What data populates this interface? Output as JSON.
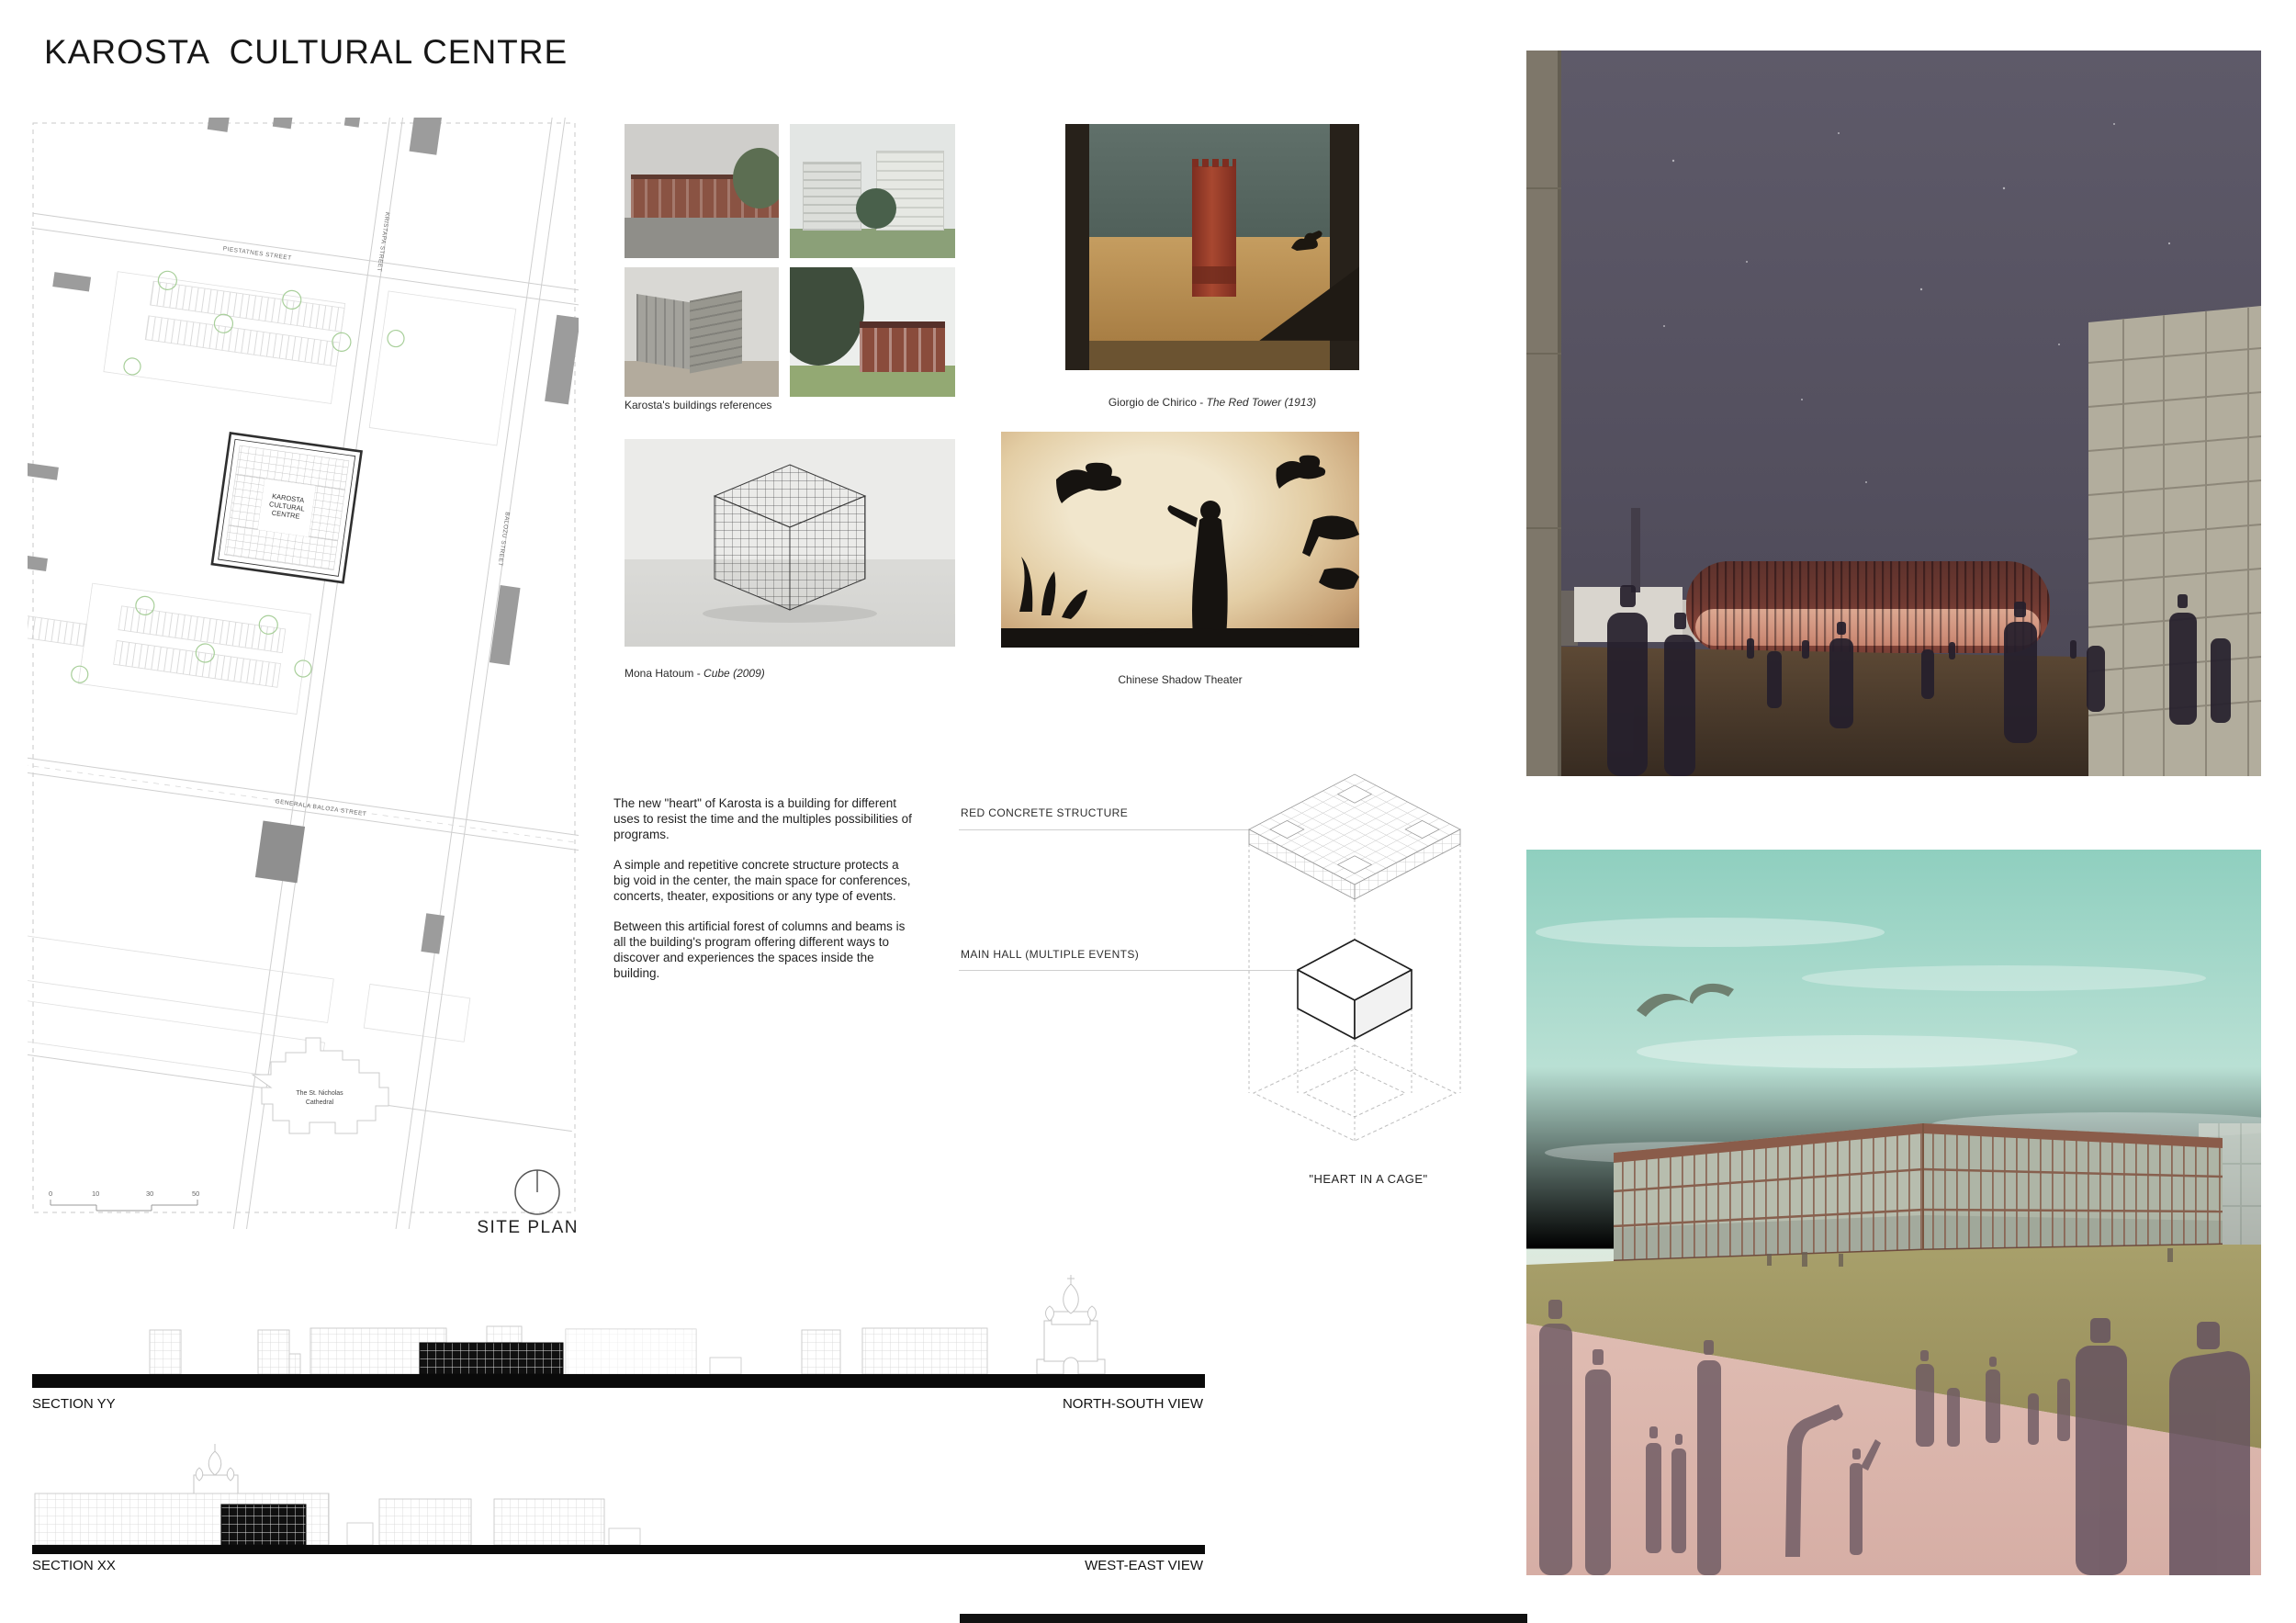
{
  "board": {
    "title": "KAROSTA  CULTURAL CENTRE"
  },
  "site_plan": {
    "label": "SITE PLAN",
    "centre_label": [
      "KAROSTA",
      "CULTURAL",
      "CENTRE"
    ],
    "cathedral_label": [
      "The St. Nicholas",
      "Cathedral"
    ],
    "street_labels": {
      "top_horizontal": "PIESTATNES STREET",
      "top_vertical": "KRISTAPA STREET",
      "mid_vertical": "BALOZU STREET",
      "main_horizontal": "GENERALA BALOZA STREET"
    },
    "scale_ticks": [
      "0",
      "10",
      "30",
      "50"
    ]
  },
  "references": {
    "caption": "Karosta's buildings references"
  },
  "artworks": {
    "chirico": {
      "artist": "Giorgio de Chirico - ",
      "work": "The Red Tower (1913)"
    },
    "hatoum": {
      "artist": "Mona Hatoum - ",
      "work": "Cube (2009)"
    },
    "shadow": {
      "caption": "Chinese Shadow Theater"
    }
  },
  "concept": {
    "p1": "The new \"heart\" of Karosta is a building for different uses to resist the time and the multiples possibilities of programs.",
    "p2": "A simple and repetitive concrete structure protects a big void in the center, the main space for conferences, concerts, theater, expositions or any type of events.",
    "p3": "Between this artificial forest of columns and beams is all the building's program offering different ways to discover and experiences the spaces inside the building."
  },
  "diagram": {
    "structure_label": "RED CONCRETE STRUCTURE",
    "hall_label": "MAIN HALL (MULTIPLE EVENTS)",
    "caption": "\"HEART IN A CAGE\""
  },
  "sections": {
    "yy": {
      "label": "SECTION YY",
      "view": "NORTH-SOUTH VIEW"
    },
    "xx": {
      "label": "SECTION XX",
      "view": "WEST-EAST VIEW"
    }
  },
  "colors": {
    "accent_red": "#7a3b33",
    "night_sky": "#55515f",
    "day_sky_teal": "#9fd4c6",
    "ground_pink": "#dcb6ac",
    "grass_olive": "#a59d68",
    "tree_green": "#a5cc96"
  }
}
